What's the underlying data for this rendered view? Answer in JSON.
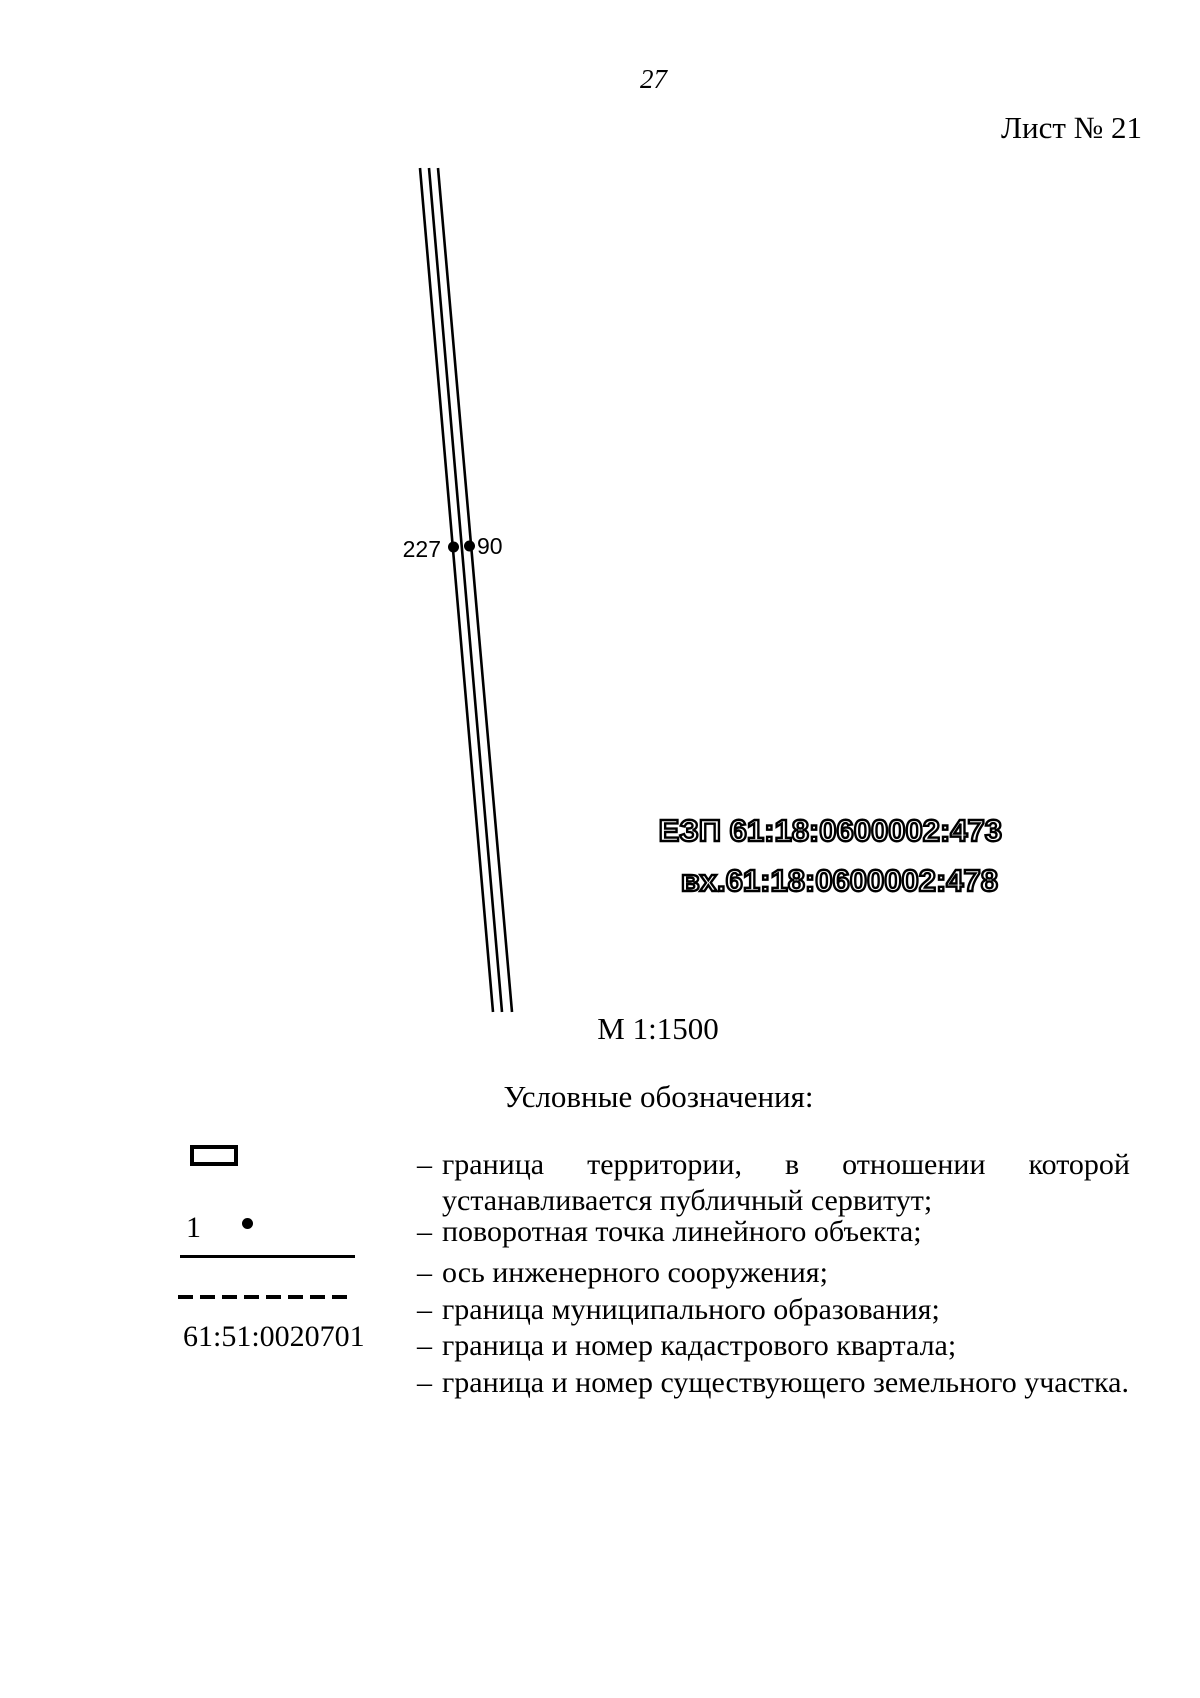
{
  "page": {
    "number": "27",
    "sheet": "Лист № 21"
  },
  "map": {
    "point_labels": {
      "left": "227",
      "right": "90"
    },
    "ezp_label": "ЕЗП 61:18:0600002:473",
    "entry_label": "вх.61:18:0600002:478",
    "scale": "М 1:1500"
  },
  "legend": {
    "heading": "Условные обозначения:",
    "marker": "–",
    "rows": [
      {
        "line1": "граница территории, в отношении которой",
        "line2": "устанавливается публичный сервитут;"
      },
      {
        "symbol_number": "1",
        "text": "поворотная точка линейного объекта;"
      },
      {
        "text": "ось инженерного сооружения;"
      },
      {
        "text": "граница муниципального образования;"
      },
      {
        "symbol_label": "61:51:0020701",
        "text": "граница и номер кадастрового квартала;"
      },
      {
        "text": "граница и номер существующего земельного участка."
      }
    ]
  }
}
